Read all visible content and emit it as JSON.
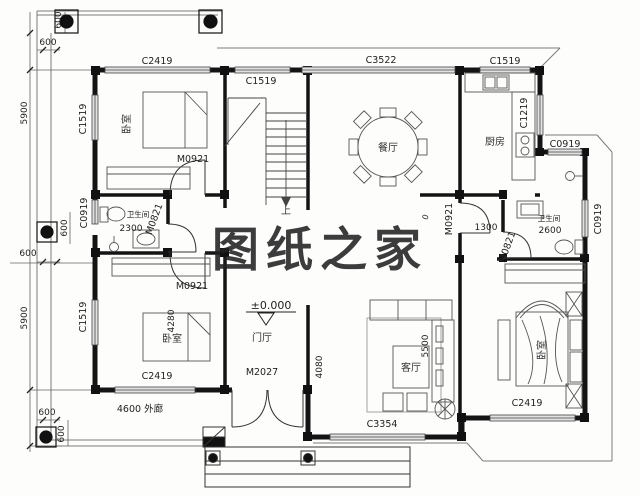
{
  "watermark": "图纸之家",
  "rooms": {
    "bedroom_tl": "卧室",
    "bedroom_bl": "卧室",
    "bedroom_br": "卧室",
    "dining": "餐厅",
    "kitchen": "厨房",
    "living": "客厅",
    "foyer": "门厅",
    "bath_left": "卫生间",
    "bath_right": "卫生间",
    "stairs_up": "上"
  },
  "level": "±0.000",
  "porch_label": "4600 外廊",
  "windows": {
    "c2419_top": "C2419",
    "c1519_stair": "C1519",
    "c3522": "C3522",
    "c1519_kitchen": "C1519",
    "c1219_kitchen": "C1219",
    "c0919_bath_top": "C0919",
    "c0919_right": "C0919",
    "c1519_left_top": "C1519",
    "c0919_left": "C0919",
    "c1519_left_bottom": "C1519",
    "c2419_bottom_left": "C2419",
    "c3354_living": "C3354",
    "c2419_bottom_right": "C2419"
  },
  "doors": {
    "m0921_bedroom_tl": "M0921",
    "m0821_bath_left": "M0821",
    "m0921_bedroom_bl": "M0921",
    "m0921_hall": "M0921",
    "m0821_bath_right": "M0821",
    "m2027_entry": "M2027"
  },
  "dims": {
    "d600": "600",
    "d5900": "5900",
    "d2300": "2300",
    "d2600": "2600",
    "d1300": "1300",
    "d4280": "4280",
    "d5500": "5500",
    "d4080": "4080",
    "d0": "0"
  },
  "colors": {
    "line": "#1a1a1a",
    "watermark": "#c23a2e",
    "dim": "#2a2a2a"
  }
}
